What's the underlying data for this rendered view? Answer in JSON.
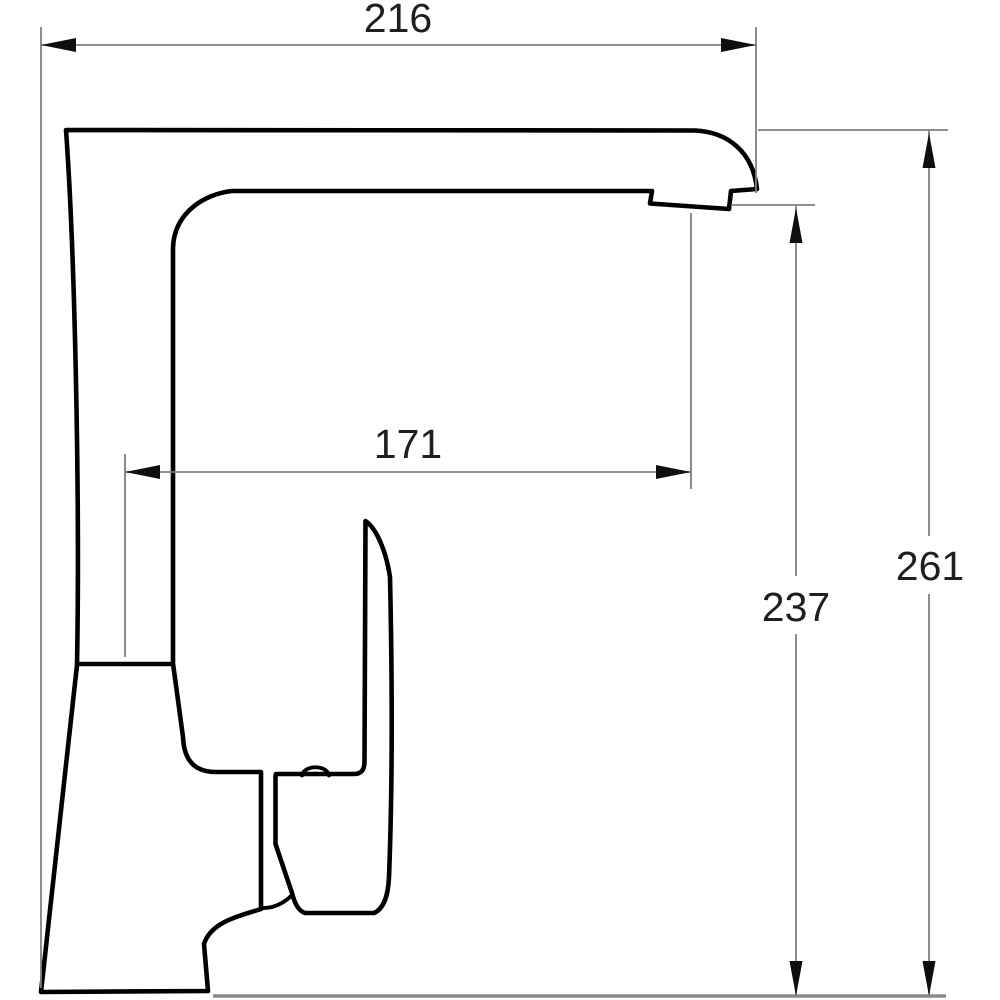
{
  "drawing": {
    "subject": "single-lever kitchen faucet side-view dimension drawing",
    "units": "mm",
    "dimensions": {
      "overall_width": "216",
      "spout_reach": "171",
      "outlet_height": "237",
      "overall_height": "261"
    },
    "colors": {
      "outline": "#000000",
      "dim": "#7f7f7f",
      "baseline": "#8a8a8a",
      "arrow": "#0f0f0f",
      "text": "#1f1f1f",
      "background": "#ffffff"
    }
  }
}
